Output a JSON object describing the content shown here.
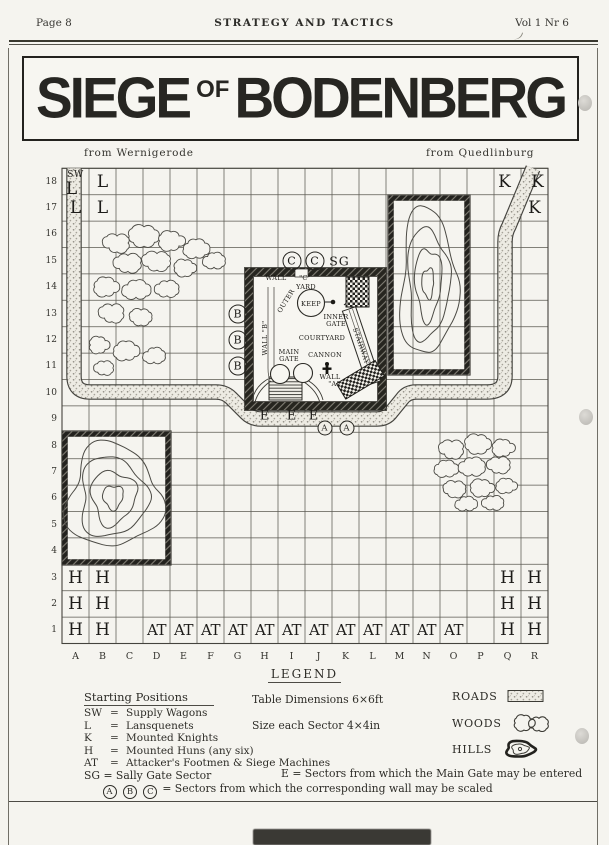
{
  "header": {
    "left": "Page 8",
    "center": "STRATEGY AND TACTICS",
    "right": "Vol 1 Nr 6"
  },
  "title": {
    "word1": "SIEGE",
    "connector": "OF",
    "word2": "BODENBERG"
  },
  "map": {
    "approach_left": "from Wernigerode",
    "approach_right": "from Quedlinburg",
    "columns": [
      "A",
      "B",
      "C",
      "D",
      "E",
      "F",
      "G",
      "H",
      "I",
      "J",
      "K",
      "L",
      "M",
      "N",
      "O",
      "P",
      "Q",
      "R"
    ],
    "rows": 18,
    "units": [
      {
        "col": "A",
        "row": 18,
        "label": "SW",
        "type": "sw",
        "dy": -7
      },
      {
        "col": "A",
        "row": 18,
        "label": "L",
        "type": "unit",
        "dx": -4,
        "dy": 7
      },
      {
        "col": "B",
        "row": 18,
        "label": "L",
        "type": "unit"
      },
      {
        "col": "A",
        "row": 17,
        "label": "L",
        "type": "unit"
      },
      {
        "col": "B",
        "row": 17,
        "label": "L",
        "type": "unit"
      },
      {
        "col": "Q",
        "row": 18,
        "label": "K",
        "type": "unit",
        "dx": -3
      },
      {
        "col": "R",
        "row": 18,
        "label": "K",
        "type": "unit",
        "dx": 3
      },
      {
        "col": "R",
        "row": 17,
        "label": "K",
        "type": "unit"
      },
      {
        "col": "G",
        "row": 13,
        "label": "B",
        "type": "circle"
      },
      {
        "col": "G",
        "row": 12,
        "label": "B",
        "type": "circle"
      },
      {
        "col": "G",
        "row": 11,
        "label": "B",
        "type": "circle"
      },
      {
        "col": "I",
        "row": 15,
        "label": "C",
        "type": "circle"
      },
      {
        "col": "J",
        "row": 15,
        "label": "C",
        "type": "circle",
        "dx": -4
      },
      {
        "col": "K",
        "row": 15,
        "label": "SG",
        "type": "sg",
        "dx": -6
      },
      {
        "col": "H",
        "row": 9,
        "label": "E",
        "type": "e",
        "dy": -3
      },
      {
        "col": "I",
        "row": 9,
        "label": "E",
        "type": "e",
        "dy": -3
      },
      {
        "col": "J",
        "row": 9,
        "label": "E",
        "type": "e",
        "dx": -5,
        "dy": -3
      },
      {
        "col": "J",
        "row": 9,
        "label": "A",
        "type": "circle-sm",
        "dx": 6,
        "dy": 9
      },
      {
        "col": "K",
        "row": 9,
        "label": "A",
        "type": "circle-sm",
        "dx": 1,
        "dy": 9
      },
      {
        "col": "A",
        "row": 3,
        "label": "H",
        "type": "unit"
      },
      {
        "col": "B",
        "row": 3,
        "label": "H",
        "type": "unit"
      },
      {
        "col": "A",
        "row": 2,
        "label": "H",
        "type": "unit"
      },
      {
        "col": "B",
        "row": 2,
        "label": "H",
        "type": "unit"
      },
      {
        "col": "A",
        "row": 1,
        "label": "H",
        "type": "unit"
      },
      {
        "col": "B",
        "row": 1,
        "label": "H",
        "type": "unit"
      },
      {
        "col": "Q",
        "row": 3,
        "label": "H",
        "type": "unit"
      },
      {
        "col": "R",
        "row": 3,
        "label": "H",
        "type": "unit"
      },
      {
        "col": "Q",
        "row": 2,
        "label": "H",
        "type": "unit"
      },
      {
        "col": "R",
        "row": 2,
        "label": "H",
        "type": "unit"
      },
      {
        "col": "Q",
        "row": 1,
        "label": "H",
        "type": "unit"
      },
      {
        "col": "R",
        "row": 1,
        "label": "H",
        "type": "unit"
      },
      {
        "col": "D",
        "row": 1,
        "label": "AT",
        "type": "at"
      },
      {
        "col": "E",
        "row": 1,
        "label": "AT",
        "type": "at"
      },
      {
        "col": "F",
        "row": 1,
        "label": "AT",
        "type": "at"
      },
      {
        "col": "G",
        "row": 1,
        "label": "AT",
        "type": "at"
      },
      {
        "col": "H",
        "row": 1,
        "label": "AT",
        "type": "at"
      },
      {
        "col": "I",
        "row": 1,
        "label": "AT",
        "type": "at"
      },
      {
        "col": "J",
        "row": 1,
        "label": "AT",
        "type": "at"
      },
      {
        "col": "K",
        "row": 1,
        "label": "AT",
        "type": "at"
      },
      {
        "col": "L",
        "row": 1,
        "label": "AT",
        "type": "at"
      },
      {
        "col": "M",
        "row": 1,
        "label": "AT",
        "type": "at"
      },
      {
        "col": "N",
        "row": 1,
        "label": "AT",
        "type": "at"
      },
      {
        "col": "O",
        "row": 1,
        "label": "AT",
        "type": "at"
      }
    ],
    "castle_labels": [
      {
        "t": "WALL",
        "x": 276,
        "y": 278
      },
      {
        "t": "\"C\"",
        "x": 305,
        "y": 278
      },
      {
        "t": "YARD",
        "x": 306,
        "y": 287
      },
      {
        "t": "OUTER",
        "x": 286,
        "y": 301,
        "r": -58
      },
      {
        "t": "KEEP",
        "x": 311,
        "y": 304
      },
      {
        "t": "INNER",
        "x": 336,
        "y": 317
      },
      {
        "t": "GATE",
        "x": 336,
        "y": 324
      },
      {
        "t": "COURTYARD",
        "x": 322,
        "y": 338
      },
      {
        "t": "CANNON",
        "x": 325,
        "y": 355
      },
      {
        "t": "MAIN",
        "x": 289,
        "y": 352
      },
      {
        "t": "GATE",
        "x": 289,
        "y": 359
      },
      {
        "t": "WALL",
        "x": 330,
        "y": 377
      },
      {
        "t": "\"A\"",
        "x": 334,
        "y": 384
      },
      {
        "t": "WALL \"B\"",
        "x": 265,
        "y": 338,
        "r": -90
      },
      {
        "t": "STAIRWAY",
        "x": 361,
        "y": 346,
        "r": 71
      }
    ]
  },
  "legend": {
    "title": "LEGEND",
    "starting_positions_title": "Starting Positions",
    "starting_positions": [
      {
        "key": "SW",
        "label": "Supply Wagons"
      },
      {
        "key": "L",
        "label": "Lansquenets"
      },
      {
        "key": "K",
        "label": "Mounted Knights"
      },
      {
        "key": "H",
        "label": "Mounted Huns (any six)"
      },
      {
        "key": "AT",
        "label": "Attacker's Footmen & Siege Machines"
      }
    ],
    "table_dimensions": "Table Dimensions 6×6ft",
    "sector_size": "Size each Sector 4×4in",
    "terrain": [
      {
        "label": "ROADS"
      },
      {
        "label": "WOODS"
      },
      {
        "label": "HILLS"
      }
    ],
    "sg_line": "SG = Sally Gate Sector",
    "e_line": "E = Sectors from which the Main Gate may be entered",
    "scaling_keys": [
      "A",
      "B",
      "C"
    ],
    "scaling_line": "= Sectors from which the corresponding wall may be scaled"
  }
}
